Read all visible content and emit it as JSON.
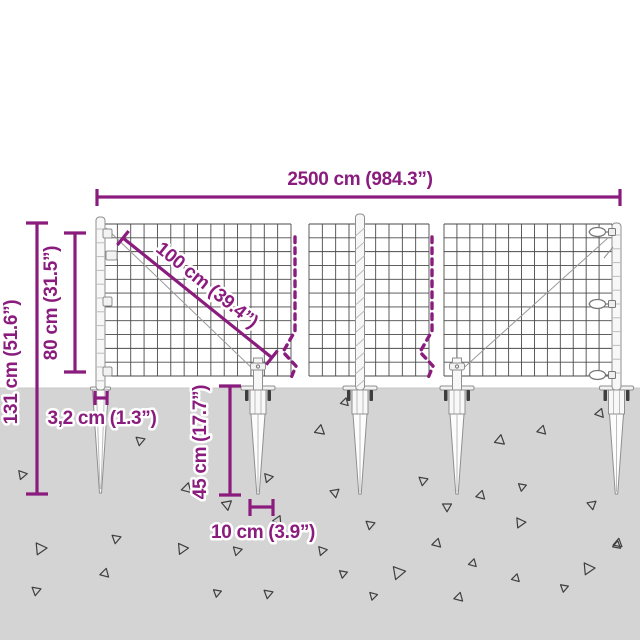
{
  "colors": {
    "accent": "#8A1C7D",
    "ground": "#D4D4D4",
    "ground_edge": "#C8C8C8",
    "wire": "#4A4A4A",
    "wire_light": "#9A9A9A",
    "metal_stroke": "#8F8F8F",
    "metal_fill": "#F7F7F7",
    "metal_detail": "#BDBDBD",
    "bolt": "#3D3D3D",
    "triangle_stroke": "#3F3F3F"
  },
  "dimensions": {
    "total_width": {
      "label": "2500 cm (984.3”)",
      "value_cm": 2500,
      "value_in": 984.3
    },
    "mesh_diagonal": {
      "label": "100 cm (39.4”)",
      "value_cm": 100,
      "value_in": 39.4
    },
    "fence_height": {
      "label": "80 cm (31.5”)",
      "value_cm": 80,
      "value_in": 31.5
    },
    "total_height": {
      "label": "131 cm (51.6”)",
      "value_cm": 131,
      "value_in": 51.6
    },
    "post_width": {
      "label": "3,2 cm (1.3”)",
      "value_cm": 3.2,
      "value_in": 1.3
    },
    "spike_length": {
      "label": "45 cm (17.7”)",
      "value_cm": 45,
      "value_in": 17.7
    },
    "spike_plate_width": {
      "label": "10 cm (3.9”)",
      "value_cm": 10,
      "value_in": 3.9
    }
  },
  "scene": {
    "ground_top": 388,
    "mesh": {
      "top": 224,
      "bottom": 376,
      "cell": 13.4,
      "rows": 11,
      "sections": [
        [
          104,
          291
        ],
        [
          309,
          429
        ],
        [
          444,
          612
        ]
      ],
      "diagonals": [
        [
          106,
          228,
          256,
          372
        ],
        [
          458,
          373,
          609,
          237
        ]
      ]
    },
    "breaks": [
      295,
      432
    ],
    "posts": [
      {
        "x": 100.5,
        "top": 217,
        "style": "rings"
      },
      {
        "x": 360,
        "top": 214,
        "style": "spiral"
      },
      {
        "x": 616.5,
        "top": 223,
        "style": "rings"
      }
    ],
    "clamps_left_post": [
      229,
      251,
      297,
      367
    ],
    "turnbuckles_right_post": [
      232,
      304,
      375
    ],
    "stubs": [
      258,
      457
    ],
    "spikes": [
      {
        "x": 100.5,
        "type": "plain"
      },
      {
        "x": 258,
        "type": "socket"
      },
      {
        "x": 360,
        "type": "socket"
      },
      {
        "x": 457,
        "type": "socket"
      },
      {
        "x": 616.5,
        "type": "socket"
      }
    ],
    "triangles": [
      [
        22,
        475,
        9,
        200
      ],
      [
        140,
        441,
        9,
        190
      ],
      [
        187,
        488,
        10,
        15
      ],
      [
        227,
        505,
        10,
        170
      ],
      [
        278,
        520,
        9,
        25
      ],
      [
        268,
        478,
        9,
        200
      ],
      [
        320,
        430,
        10,
        10
      ],
      [
        345,
        402,
        8,
        15
      ],
      [
        335,
        493,
        9,
        170
      ],
      [
        423,
        481,
        9,
        190
      ],
      [
        447,
        507,
        9,
        180
      ],
      [
        481,
        495,
        9,
        15
      ],
      [
        500,
        440,
        10,
        10
      ],
      [
        542,
        430,
        9,
        15
      ],
      [
        522,
        487,
        8,
        190
      ],
      [
        592,
        505,
        9,
        170
      ],
      [
        600,
        413,
        9,
        20
      ],
      [
        618,
        543,
        9,
        10
      ],
      [
        40,
        549,
        12,
        205
      ],
      [
        116,
        539,
        9,
        190
      ],
      [
        182,
        549,
        11,
        205
      ],
      [
        237,
        551,
        9,
        195
      ],
      [
        322,
        551,
        9,
        200
      ],
      [
        105,
        573,
        9,
        15
      ],
      [
        36,
        591,
        9,
        190
      ],
      [
        268,
        594,
        9,
        190
      ],
      [
        217,
        593,
        8,
        190
      ],
      [
        373,
        596,
        8,
        195
      ],
      [
        370,
        525,
        9,
        190
      ],
      [
        520,
        523,
        10,
        205
      ],
      [
        437,
        543,
        9,
        15
      ],
      [
        617,
        545,
        8,
        10
      ],
      [
        473,
        563,
        8,
        15
      ],
      [
        398,
        573,
        13,
        200
      ],
      [
        343,
        574,
        8,
        190
      ],
      [
        588,
        569,
        12,
        205
      ],
      [
        516,
        578,
        8,
        15
      ],
      [
        564,
        588,
        8,
        190
      ],
      [
        459,
        597,
        9,
        15
      ]
    ]
  }
}
